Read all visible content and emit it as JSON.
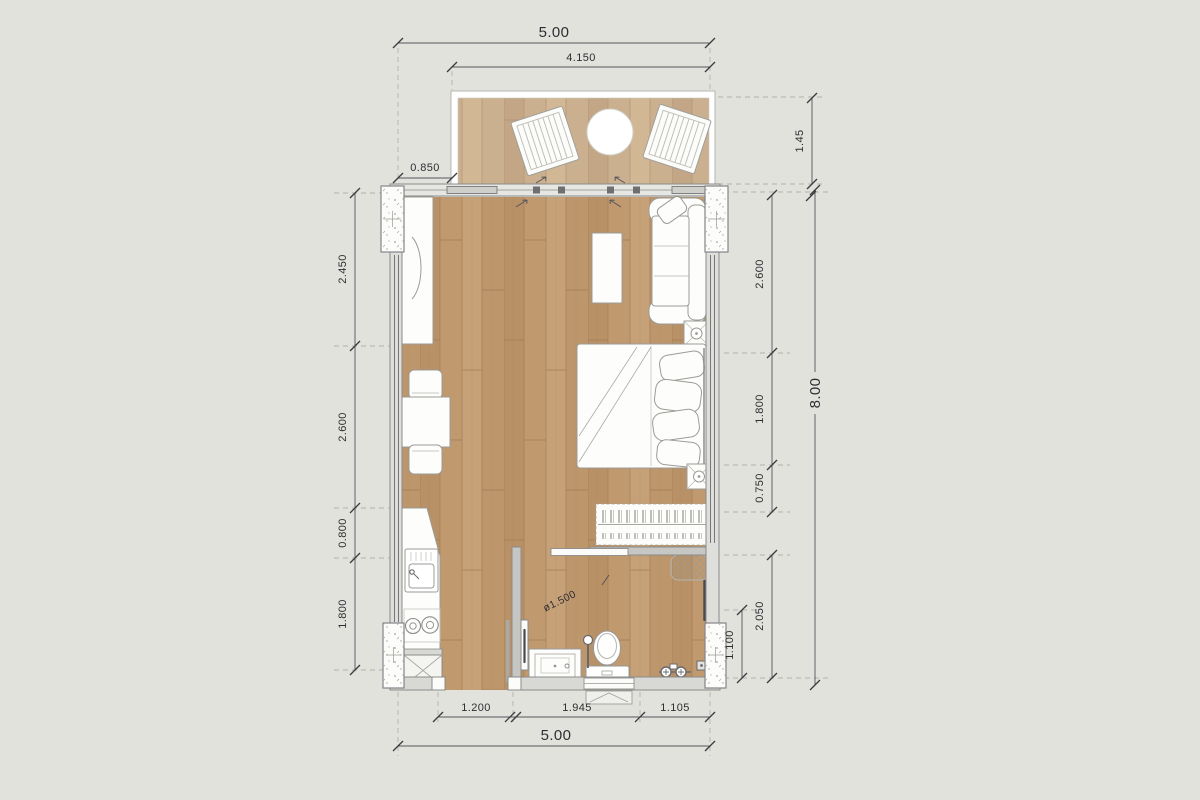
{
  "title": "studio-unit-floor-plan",
  "dimensions": {
    "top": {
      "overall_width": "5.00",
      "balcony_width": "4.150",
      "left_offset": "0.850",
      "balcony_depth": "1.45"
    },
    "left": {
      "desk_zone": "2.450",
      "dining_zone": "2.600",
      "counter_corner": "0.800",
      "kitchen_zone": "1.800"
    },
    "right": {
      "living_zone": "2.600",
      "bed_zone": "1.800",
      "wardrobe_gap": "0.750",
      "bathroom_zone": "2.050",
      "bathroom_inner": "1.100",
      "overall_height": "8.00"
    },
    "bottom": {
      "kitchen_width": "1.200",
      "bath_width": "1.945",
      "shower_width": "1.105",
      "overall_width": "5.00"
    },
    "bathroom": {
      "turning_circle": "ø1.500"
    }
  },
  "colors": {
    "background": "#e2e2dd",
    "floor_wood": "#c0996f",
    "balcony_wood": "#cbb090",
    "wall_line": "#8b8b89",
    "dimension_text": "#2e2e32"
  }
}
